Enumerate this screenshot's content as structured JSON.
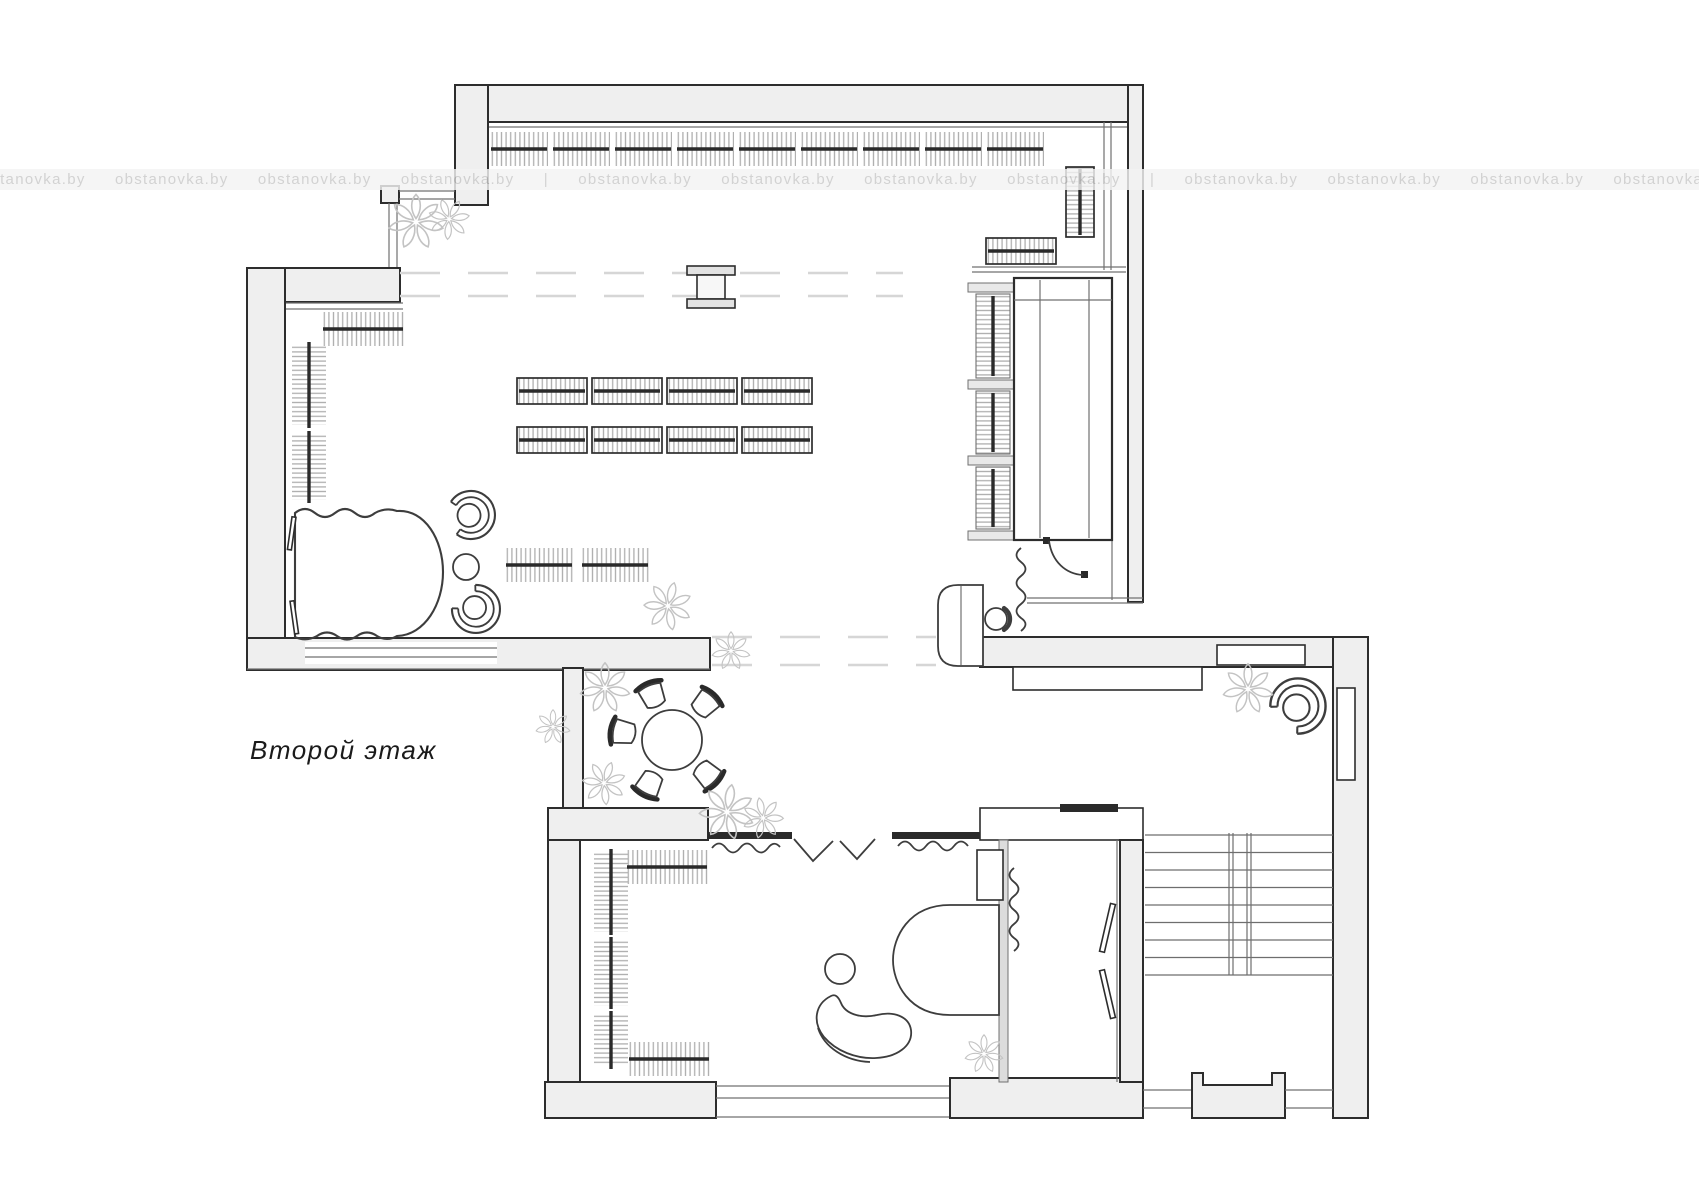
{
  "plan": {
    "floor_label": "Второй этаж",
    "colors": {
      "wall_fill": "#efefef",
      "wall_stroke": "#2d2d2d",
      "thin": "#707070",
      "furn": "#3d3d3d",
      "hatch": "#aeaeae",
      "dark_bar": "#2a2a2a",
      "dashed": "#d6d6d6",
      "plant": "#c3c3c3",
      "stair": "#6e6e6e",
      "title": "#1b1b1b",
      "watermark_band": "#f3f3f3",
      "watermark_text": "#c9c9c9",
      "paper": "#ffffff"
    }
  },
  "watermark": {
    "text": "obstanovka.by",
    "separator": "|",
    "repeats": 12,
    "separator_after": [
      4,
      8
    ]
  }
}
